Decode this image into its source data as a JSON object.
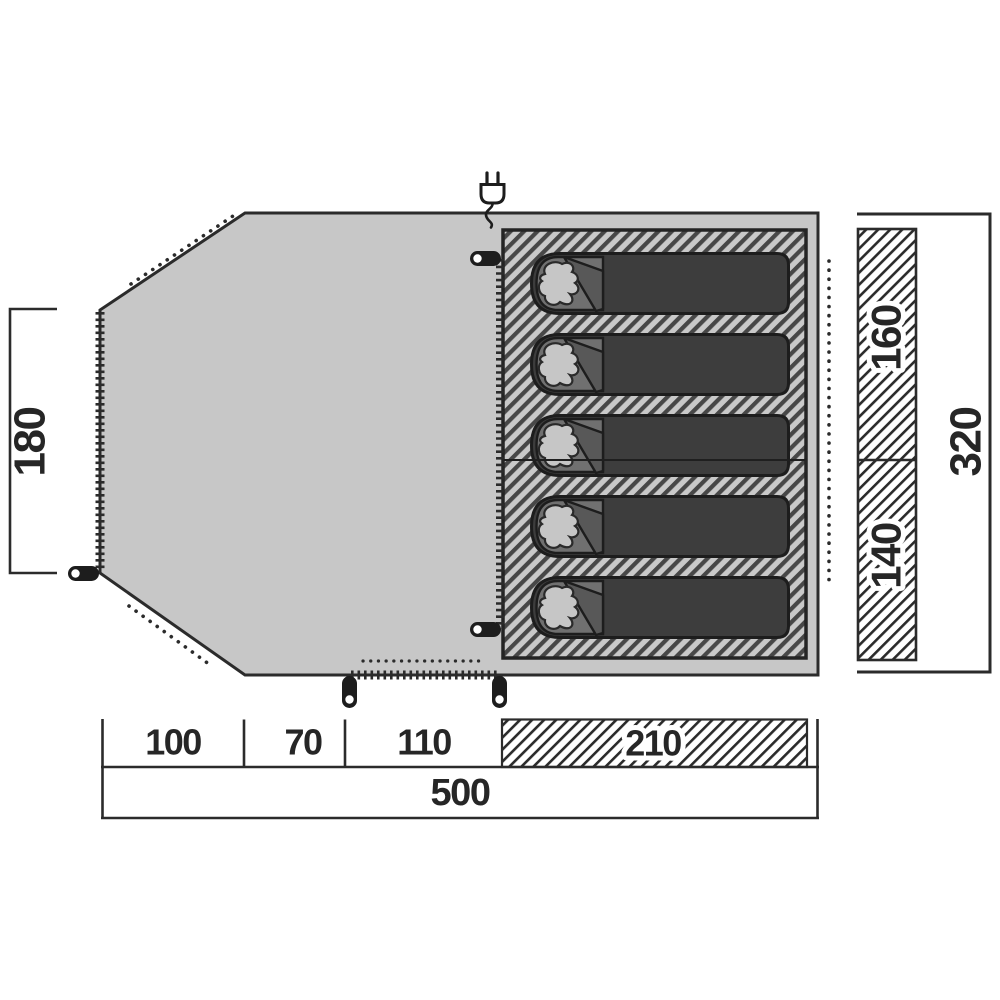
{
  "diagram": {
    "type": "tent-floorplan-top-view",
    "dimensions": {
      "left_height": "180",
      "right_total_height": "320",
      "inner_top_height": "160",
      "inner_bottom_height": "140",
      "bottom_segments": [
        "100",
        "70",
        "110",
        "210"
      ],
      "bottom_total": "500"
    },
    "sleeping_bag_count": 5,
    "icons": {
      "plug": "power-hookup-plug-icon",
      "peg": "tent-peg-icon",
      "bag": "sleeping-bag-icon"
    },
    "colors": {
      "floor": "#c7c7c7",
      "outline": "#2b2b2b",
      "hatch_stripe": "#474747",
      "bag_body": "#3d3d3d",
      "bag_hood": "#707070",
      "bag_flap": "#585858",
      "bag_pillow": "#c6c6c6",
      "label_text": "#262626"
    }
  }
}
